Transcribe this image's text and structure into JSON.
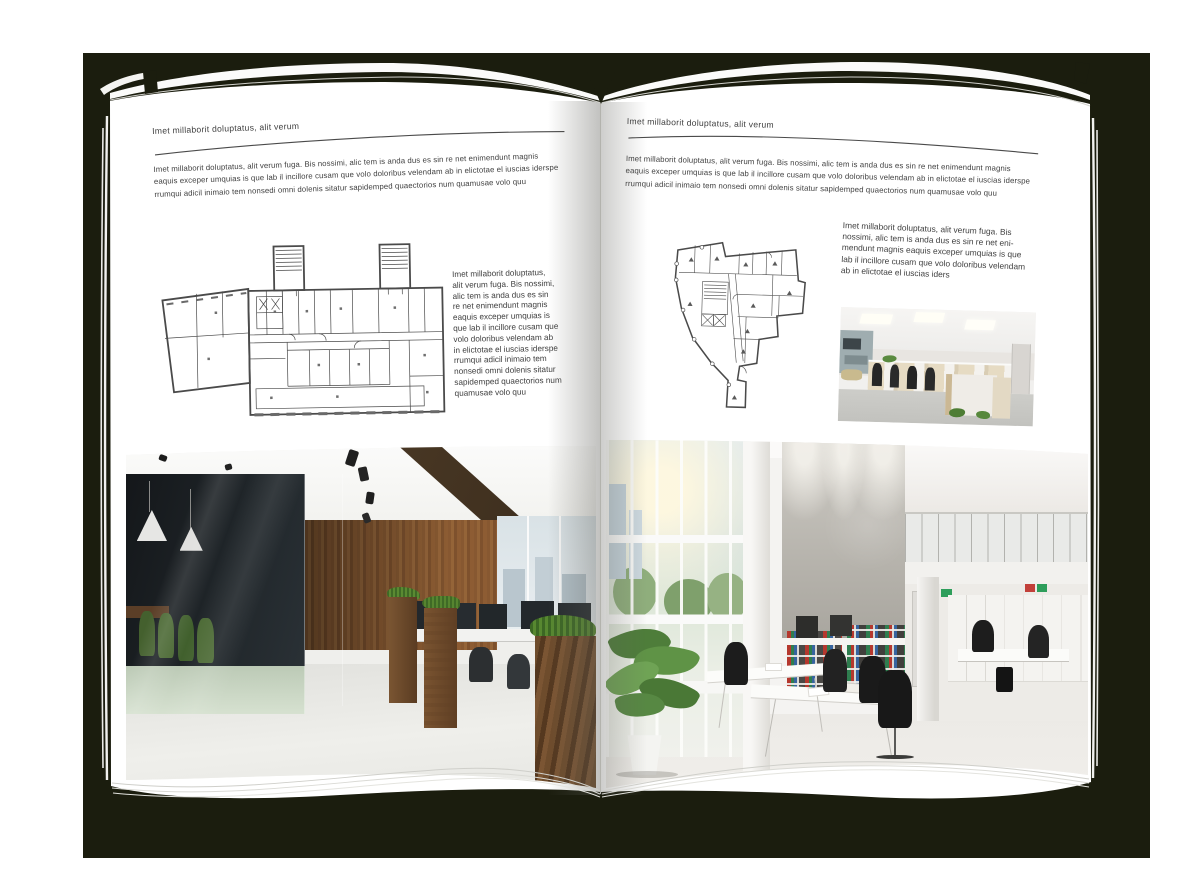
{
  "document": {
    "type": "interior-design brochure spread mockup",
    "colors": {
      "backdrop": "#1b1d0e",
      "page": "#ffffff",
      "text": "#3f3f3f",
      "rule": "#4a4a4a",
      "plan_lines": "#4a4a4a"
    },
    "pages": {
      "left": {
        "header": "Imet millaborit doluptatus, alit verum",
        "intro_lines": [
          "Imet millaborit doluptatus, alit verum fuga. Bis nossimi, alic tem is anda dus es sin re net enimendunt magnis",
          "eaquis exceper umquias is que lab il incillore cusam que volo doloribus velendam ab in elictotae el iuscias iderspe",
          "rrumqui adicil inimaio tem nonsedi omni dolenis sitatur sapidemped quaectorios num quamusae volo quu"
        ],
        "side_text_lines": [
          "Imet millaborit doluptatus,",
          "alit verum fuga. Bis nossimi,",
          "alic tem is anda dus es sin",
          "re net enimendunt magnis",
          "eaquis exceper umquias is",
          "que lab il incillore cusam que",
          "volo doloribus velendam ab",
          "in elictotae el iuscias iderspe",
          "rrumqui adicil inimaio tem",
          "nonsedi omni dolenis sitatur",
          "sapidemped quaectorios num",
          "quamusae volo quu"
        ]
      },
      "right": {
        "header": "Imet millaborit doluptatus, alit verum",
        "intro_lines": [
          "Imet millaborit doluptatus, alit verum fuga. Bis nossimi, alic tem is anda dus es sin re net enimendunt magnis",
          "eaquis exceper umquias is que lab il incillore cusam que volo doloribus velendam ab in elictotae el iuscias iderspe",
          "rrumqui adicil inimaio tem nonsedi omni dolenis sitatur sapidemped quaectorios num quamusae volo quu"
        ],
        "side_text_lines": [
          "Imet millaborit doluptatus, alit verum fuga. Bis",
          "nossimi, alic tem is anda dus es sin re net eni-",
          "mendunt magnis eaquis exceper umquias is que",
          "lab il incillore cusam que volo doloribus velendam",
          "ab in elictotae el iuscias iders"
        ]
      }
    }
  }
}
